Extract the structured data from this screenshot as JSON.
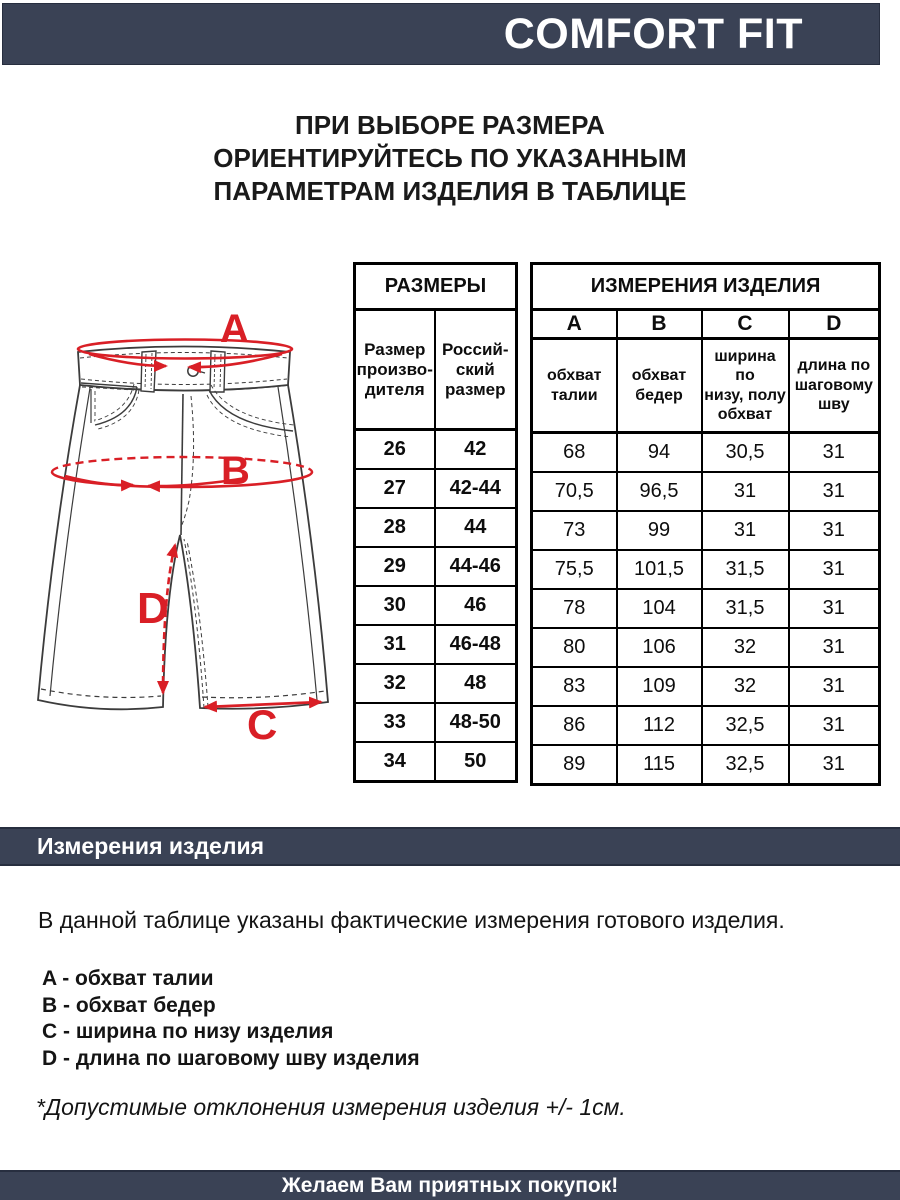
{
  "colors": {
    "navy": "#3a4255",
    "red": "#d91f26",
    "line": "#3c3c3c"
  },
  "top_bar": {
    "title": "COMFORT FIT"
  },
  "intro": {
    "text": "ПРИ ВЫБОРЕ РАЗМЕРА\nОРИЕНТИРУЙТЕСЬ ПО УКАЗАННЫМ\nПАРАМЕТРАМ ИЗДЕЛИЯ В ТАБЛИЦЕ"
  },
  "figure": {
    "labels": [
      "A",
      "B",
      "C",
      "D"
    ]
  },
  "size_table": {
    "title": "РАЗМЕРЫ",
    "columns": [
      "Размер\nпроизво-\nдителя",
      "Россий-\nский\nразмер"
    ],
    "rows": [
      [
        "26",
        "42"
      ],
      [
        "27",
        "42-44"
      ],
      [
        "28",
        "44"
      ],
      [
        "29",
        "44-46"
      ],
      [
        "30",
        "46"
      ],
      [
        "31",
        "46-48"
      ],
      [
        "32",
        "48"
      ],
      [
        "33",
        "48-50"
      ],
      [
        "34",
        "50"
      ]
    ]
  },
  "measure_table": {
    "title": "ИЗМЕРЕНИЯ ИЗДЕЛИЯ",
    "letters": [
      "A",
      "B",
      "C",
      "D"
    ],
    "descriptions": [
      "обхват\nталии",
      "обхват\nбедер",
      "ширина по\nнизу, полу\nобхват",
      "длина по\nшаговому\nшву"
    ],
    "rows": [
      [
        "68",
        "94",
        "30,5",
        "31"
      ],
      [
        "70,5",
        "96,5",
        "31",
        "31"
      ],
      [
        "73",
        "99",
        "31",
        "31"
      ],
      [
        "75,5",
        "101,5",
        "31,5",
        "31"
      ],
      [
        "78",
        "104",
        "31,5",
        "31"
      ],
      [
        "80",
        "106",
        "32",
        "31"
      ],
      [
        "83",
        "109",
        "32",
        "31"
      ],
      [
        "86",
        "112",
        "32,5",
        "31"
      ],
      [
        "89",
        "115",
        "32,5",
        "31"
      ]
    ]
  },
  "section_bar": {
    "title": "Измерения изделия"
  },
  "body": {
    "intro": "В данной таблице указаны фактические измерения готового изделия.",
    "legend": [
      "A - обхват талии",
      "B - обхват бедер",
      "C - ширина по низу изделия",
      "D - длина по шаговому шву изделия"
    ],
    "note": "*Допустимые отклонения измерения изделия +/- 1см."
  },
  "footer": {
    "message": "Желаем Вам приятных покупок!"
  }
}
